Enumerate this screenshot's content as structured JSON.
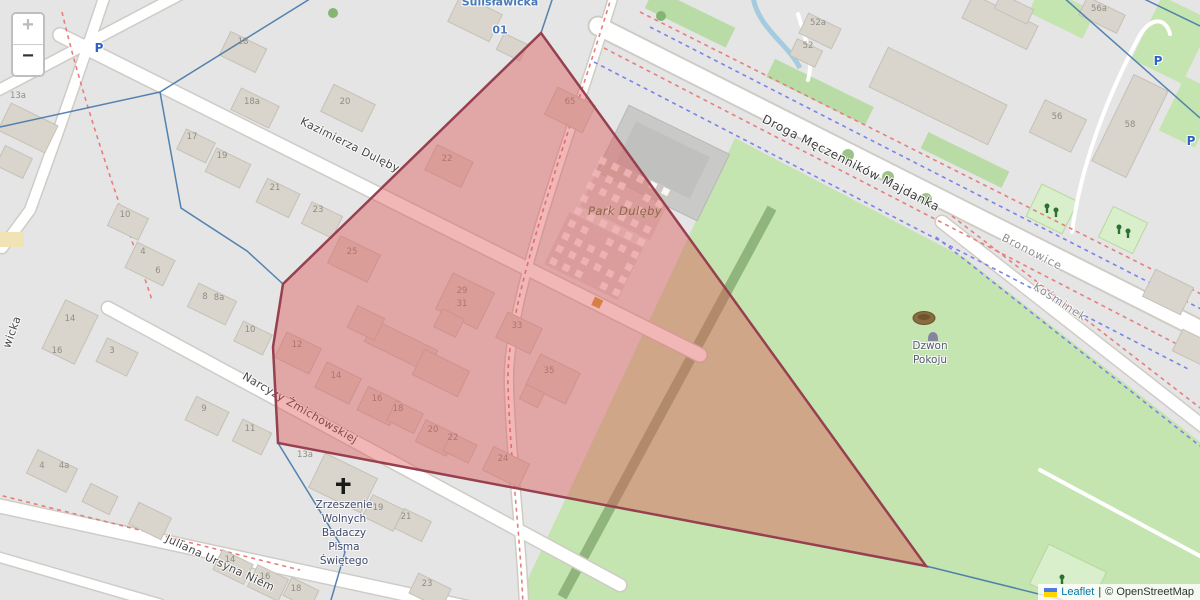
{
  "controls": {
    "zoom_in_label": "+",
    "zoom_out_label": "−"
  },
  "attribution": {
    "leaflet_link": "Leaflet",
    "separator": "|",
    "osm_text": "© OpenStreetMap",
    "flag_top_color": "#4C7BE1",
    "flag_bottom_color": "#FFD500"
  },
  "overlay": {
    "polygon_points": "541,33 926,566 278,443 273,347 283,284",
    "fill_color": "#dd5252",
    "fill_opacity": "0.42",
    "stroke_color": "#97404f",
    "stroke_width": "2.5"
  },
  "boundaries": {
    "color": "#4477aa",
    "lines": [
      "0,127 160,92 313,-3",
      "160,92 181,208 247,251 283,284",
      "283,284 273,347 278,443 345,552 331,600",
      "553,-3 541,33",
      "541,33 926,566",
      "926,566 1063,600",
      "1063,-3 1200,118",
      "1140,-3 1200,26"
    ]
  },
  "map_labels": [
    {
      "t": "Kazimierza Dulęby",
      "x": 350,
      "y": 145,
      "r": 26.5,
      "c": "street"
    },
    {
      "t": "Narcyzy Żmichowskiej",
      "x": 300,
      "y": 408,
      "r": 30,
      "c": "street"
    },
    {
      "t": "Juliana Ursyna Niem",
      "x": 220,
      "y": 563,
      "r": 25,
      "c": "street"
    },
    {
      "t": "Droga Męczenników Majdanka",
      "x": 851,
      "y": 163,
      "r": 27,
      "c": "street-big"
    },
    {
      "t": "Bronowice",
      "x": 1032,
      "y": 252,
      "r": 27,
      "c": "place"
    },
    {
      "t": "Kośminek",
      "x": 1060,
      "y": 302,
      "r": 33,
      "c": "place"
    },
    {
      "t": "wicka",
      "x": 12,
      "y": 332,
      "r": -70,
      "c": "street"
    },
    {
      "t": "Sulisławicka",
      "x": 500,
      "y": 2,
      "r": 0,
      "c": "transit"
    },
    {
      "t": "01",
      "x": 500,
      "y": 30,
      "r": 0,
      "c": "transit"
    },
    {
      "t": "Park Dulęby",
      "x": 625,
      "y": 211,
      "r": 0,
      "c": "park"
    },
    {
      "t": "Dzwon",
      "x": 930,
      "y": 346,
      "r": 0,
      "c": "poi"
    },
    {
      "t": "Pokoju",
      "x": 930,
      "y": 360,
      "r": 0,
      "c": "poi"
    },
    {
      "t": "Zrzeszenie",
      "x": 344,
      "y": 505,
      "r": 0,
      "c": "church"
    },
    {
      "t": "Wolnych",
      "x": 344,
      "y": 519,
      "r": 0,
      "c": "church"
    },
    {
      "t": "Badaczy",
      "x": 344,
      "y": 533,
      "r": 0,
      "c": "church"
    },
    {
      "t": "Pisma",
      "x": 344,
      "y": 547,
      "r": 0,
      "c": "church"
    },
    {
      "t": "Świętego",
      "x": 344,
      "y": 561,
      "r": 0,
      "c": "church"
    },
    {
      "t": "P",
      "x": 99,
      "y": 48,
      "r": 0,
      "c": "parking"
    },
    {
      "t": "P",
      "x": 1158,
      "y": 61,
      "r": 0,
      "c": "parking"
    },
    {
      "t": "P",
      "x": 1191,
      "y": 141,
      "r": 0,
      "c": "parking"
    }
  ],
  "house_numbers": [
    {
      "t": "13a",
      "x": 18,
      "y": 96
    },
    {
      "t": "18",
      "x": 243,
      "y": 42
    },
    {
      "t": "18a",
      "x": 252,
      "y": 102
    },
    {
      "t": "20",
      "x": 345,
      "y": 102
    },
    {
      "t": "22",
      "x": 447,
      "y": 159
    },
    {
      "t": "65",
      "x": 570,
      "y": 102
    },
    {
      "t": "17",
      "x": 192,
      "y": 137
    },
    {
      "t": "19",
      "x": 222,
      "y": 156
    },
    {
      "t": "21",
      "x": 275,
      "y": 188
    },
    {
      "t": "23",
      "x": 318,
      "y": 210
    },
    {
      "t": "25",
      "x": 352,
      "y": 252
    },
    {
      "t": "10",
      "x": 125,
      "y": 215
    },
    {
      "t": "4",
      "x": 143,
      "y": 252
    },
    {
      "t": "6",
      "x": 158,
      "y": 271
    },
    {
      "t": "8",
      "x": 205,
      "y": 297
    },
    {
      "t": "8a",
      "x": 219,
      "y": 298
    },
    {
      "t": "10",
      "x": 250,
      "y": 330
    },
    {
      "t": "14",
      "x": 70,
      "y": 319
    },
    {
      "t": "16",
      "x": 57,
      "y": 351
    },
    {
      "t": "3",
      "x": 112,
      "y": 351
    },
    {
      "t": "12",
      "x": 297,
      "y": 345
    },
    {
      "t": "14",
      "x": 336,
      "y": 376
    },
    {
      "t": "16",
      "x": 377,
      "y": 399
    },
    {
      "t": "18",
      "x": 398,
      "y": 409
    },
    {
      "t": "20",
      "x": 433,
      "y": 430
    },
    {
      "t": "22",
      "x": 453,
      "y": 438
    },
    {
      "t": "24",
      "x": 503,
      "y": 459
    },
    {
      "t": "29",
      "x": 462,
      "y": 291
    },
    {
      "t": "31",
      "x": 462,
      "y": 304
    },
    {
      "t": "33",
      "x": 517,
      "y": 326
    },
    {
      "t": "35",
      "x": 549,
      "y": 371
    },
    {
      "t": "9",
      "x": 204,
      "y": 409
    },
    {
      "t": "11",
      "x": 250,
      "y": 429
    },
    {
      "t": "4",
      "x": 42,
      "y": 466
    },
    {
      "t": "4a",
      "x": 64,
      "y": 466
    },
    {
      "t": "13a",
      "x": 305,
      "y": 455
    },
    {
      "t": "19",
      "x": 378,
      "y": 508
    },
    {
      "t": "21",
      "x": 406,
      "y": 517
    },
    {
      "t": "16",
      "x": 265,
      "y": 577
    },
    {
      "t": "18",
      "x": 296,
      "y": 589
    },
    {
      "t": "23",
      "x": 427,
      "y": 584
    },
    {
      "t": "14",
      "x": 230,
      "y": 560
    },
    {
      "t": "52a",
      "x": 818,
      "y": 23
    },
    {
      "t": "52",
      "x": 808,
      "y": 46
    },
    {
      "t": "56",
      "x": 1057,
      "y": 117
    },
    {
      "t": "58",
      "x": 1130,
      "y": 125
    },
    {
      "t": "56a",
      "x": 1099,
      "y": 9
    }
  ]
}
